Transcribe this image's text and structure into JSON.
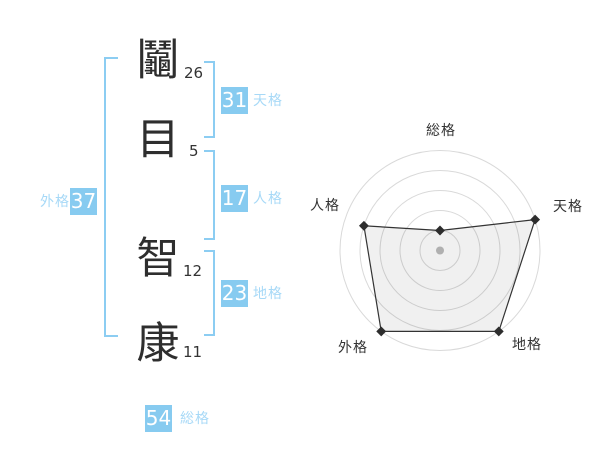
{
  "name": {
    "characters": [
      {
        "char": "鬮",
        "strokes": "26"
      },
      {
        "char": "目",
        "strokes": "5"
      },
      {
        "char": "智",
        "strokes": "12"
      },
      {
        "char": "康",
        "strokes": "11"
      }
    ]
  },
  "gokaku": {
    "tenkaku": {
      "value": "31",
      "label": "天格"
    },
    "jinkaku": {
      "value": "17",
      "label": "人格"
    },
    "chikaku": {
      "value": "23",
      "label": "地格"
    },
    "gaikaku": {
      "value": "37",
      "label": "外格"
    },
    "soukaku": {
      "value": "54",
      "label": "総格"
    }
  },
  "colors": {
    "box_blue": "#87cbf0",
    "bracket_blue": "#8ccdf2",
    "label_blue": "#a7d9f7",
    "text_dark": "#333333",
    "grid_gray": "#d9d9d9",
    "marker_dark": "#2d2d2d",
    "center_dot_gray": "#bcbcbc",
    "polygon_fill": "rgba(0,0,0,0.06)"
  },
  "chart_data": {
    "type": "radar",
    "axes": [
      "総格",
      "天格",
      "地格",
      "外格",
      "人格"
    ],
    "values": [
      1,
      5,
      5,
      5,
      4
    ],
    "max": 5,
    "rings": 5,
    "grid": "circular",
    "legend": false,
    "title": ""
  }
}
